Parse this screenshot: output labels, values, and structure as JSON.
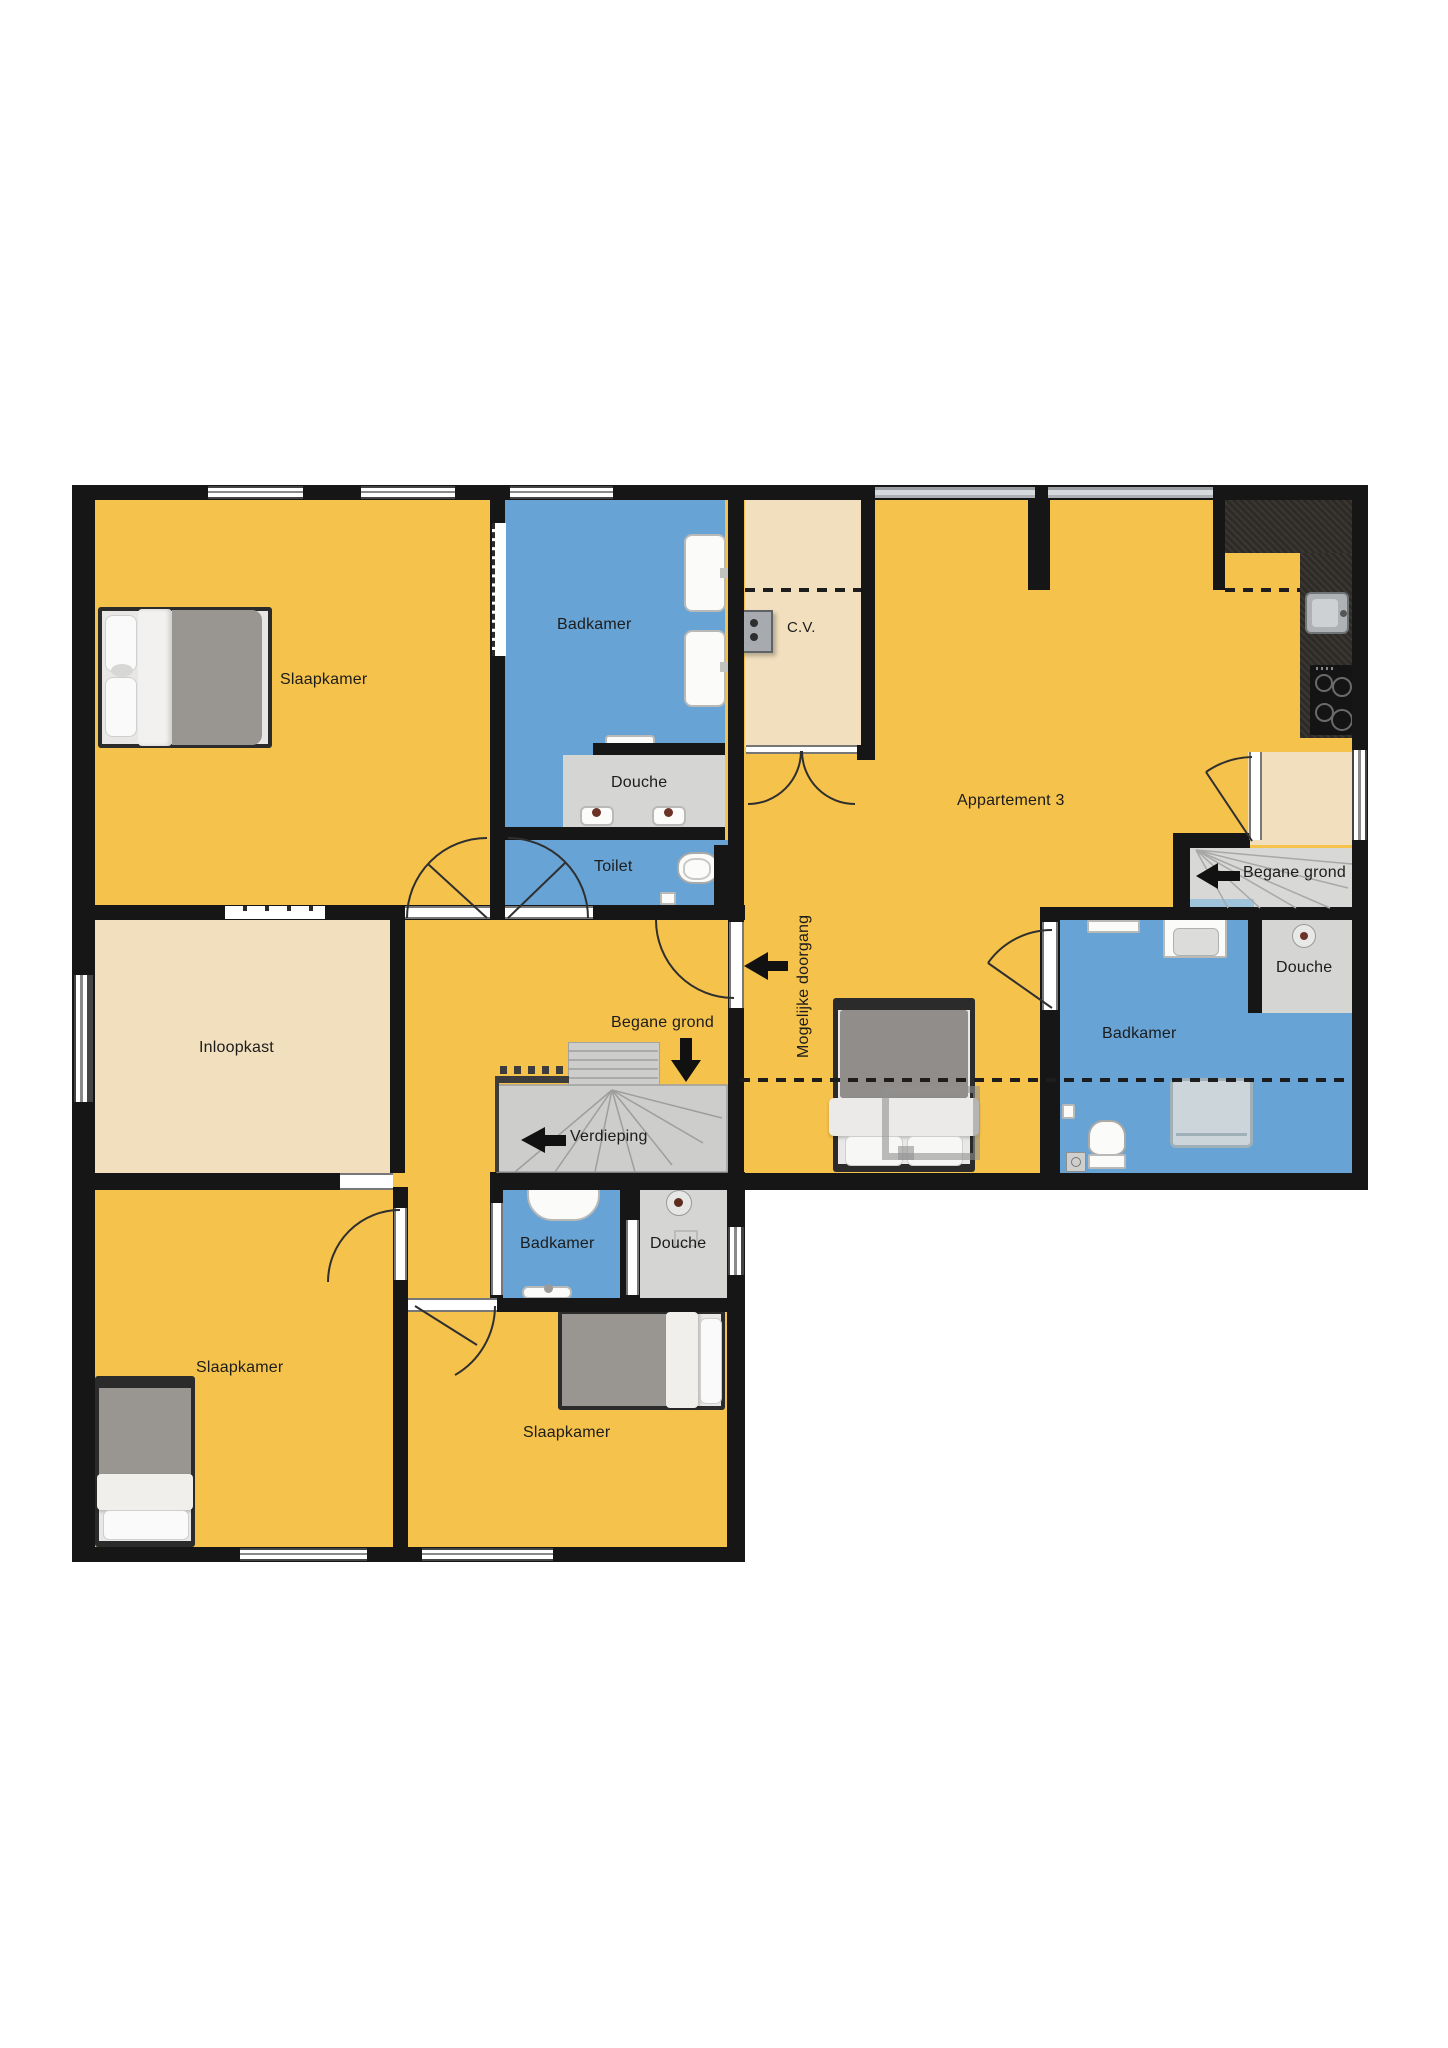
{
  "floorplan": {
    "rooms": {
      "slaapkamer_topleft": "Slaapkamer",
      "badkamer_top": "Badkamer",
      "douche_top": "Douche",
      "toilet": "Toilet",
      "cv": "C.V.",
      "appartement_3": "Appartement 3",
      "douche_right": "Douche",
      "badkamer_right": "Badkamer",
      "inloopkast": "Inloopkast",
      "badkamer_middle": "Badkamer",
      "douche_middle": "Douche",
      "slaapkamer_bottomleft": "Slaapkamer",
      "slaapkamer_bottommiddle": "Slaapkamer"
    },
    "annotations": {
      "stairs_right_label": "Begane grond",
      "stairs_middle_down_label": "Begane grond",
      "stairs_middle_up_label": "Verdieping",
      "possible_passage_label": "Mogelijke doorgang"
    },
    "colors": {
      "floor_yellow": "#F5C24B",
      "bathroom_blue": "#67A3D4",
      "closet_beige": "#F1DFBE",
      "shower_gray": "#D5D5D3",
      "wall_black": "#161616",
      "kitchen_counter": "#2E2B27"
    }
  }
}
